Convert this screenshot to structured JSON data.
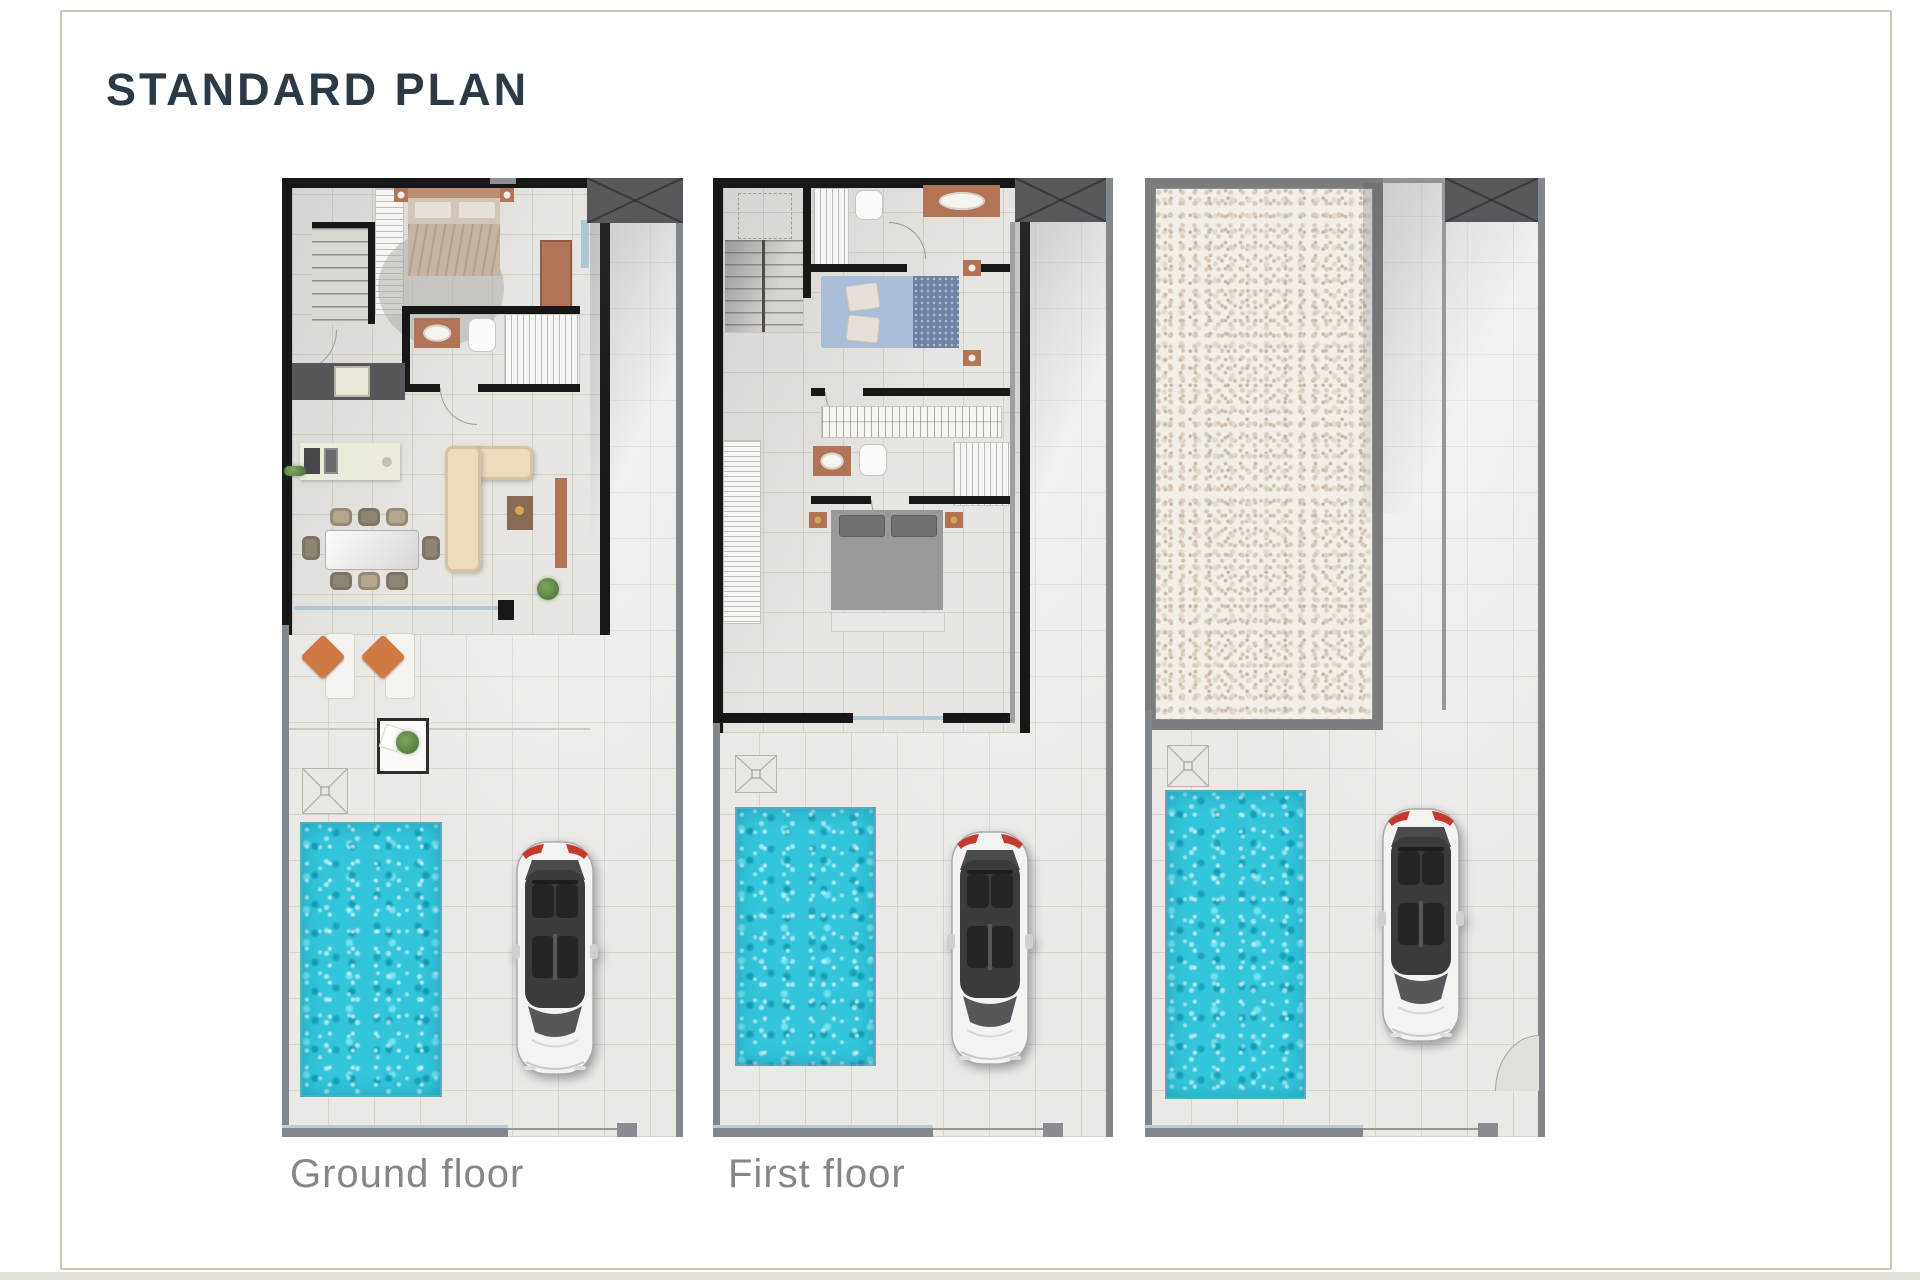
{
  "page": {
    "title": "STANDARD PLAN",
    "title_color": "#2d3944",
    "background": "#ffffff",
    "frame_border_color": "#cfc7b5"
  },
  "plans": [
    {
      "id": "ground-floor",
      "label": "Ground floor"
    },
    {
      "id": "first-floor",
      "label": "First floor"
    },
    {
      "id": "solarium-roof",
      "label": ""
    }
  ],
  "palette": {
    "pool_water": "#33c5db",
    "wall_interior": "#171717",
    "wall_boundary": "#82878b",
    "pool_fence_accent": "#b9cdd9",
    "tile_floor": "#ebe9e6",
    "gravel_base": "#f2eee8",
    "canopy": "#57585b",
    "label_color": "#868686",
    "car_body": "#f3f3f2",
    "terrace_cushion": "#cf7a44",
    "furniture_wood": "#b27457",
    "sofa_fabric": "#eddbbc",
    "lamp_gold": "#d4a74f",
    "bed_blue": "#a8bdd8",
    "bed_gray": "#98999b"
  }
}
